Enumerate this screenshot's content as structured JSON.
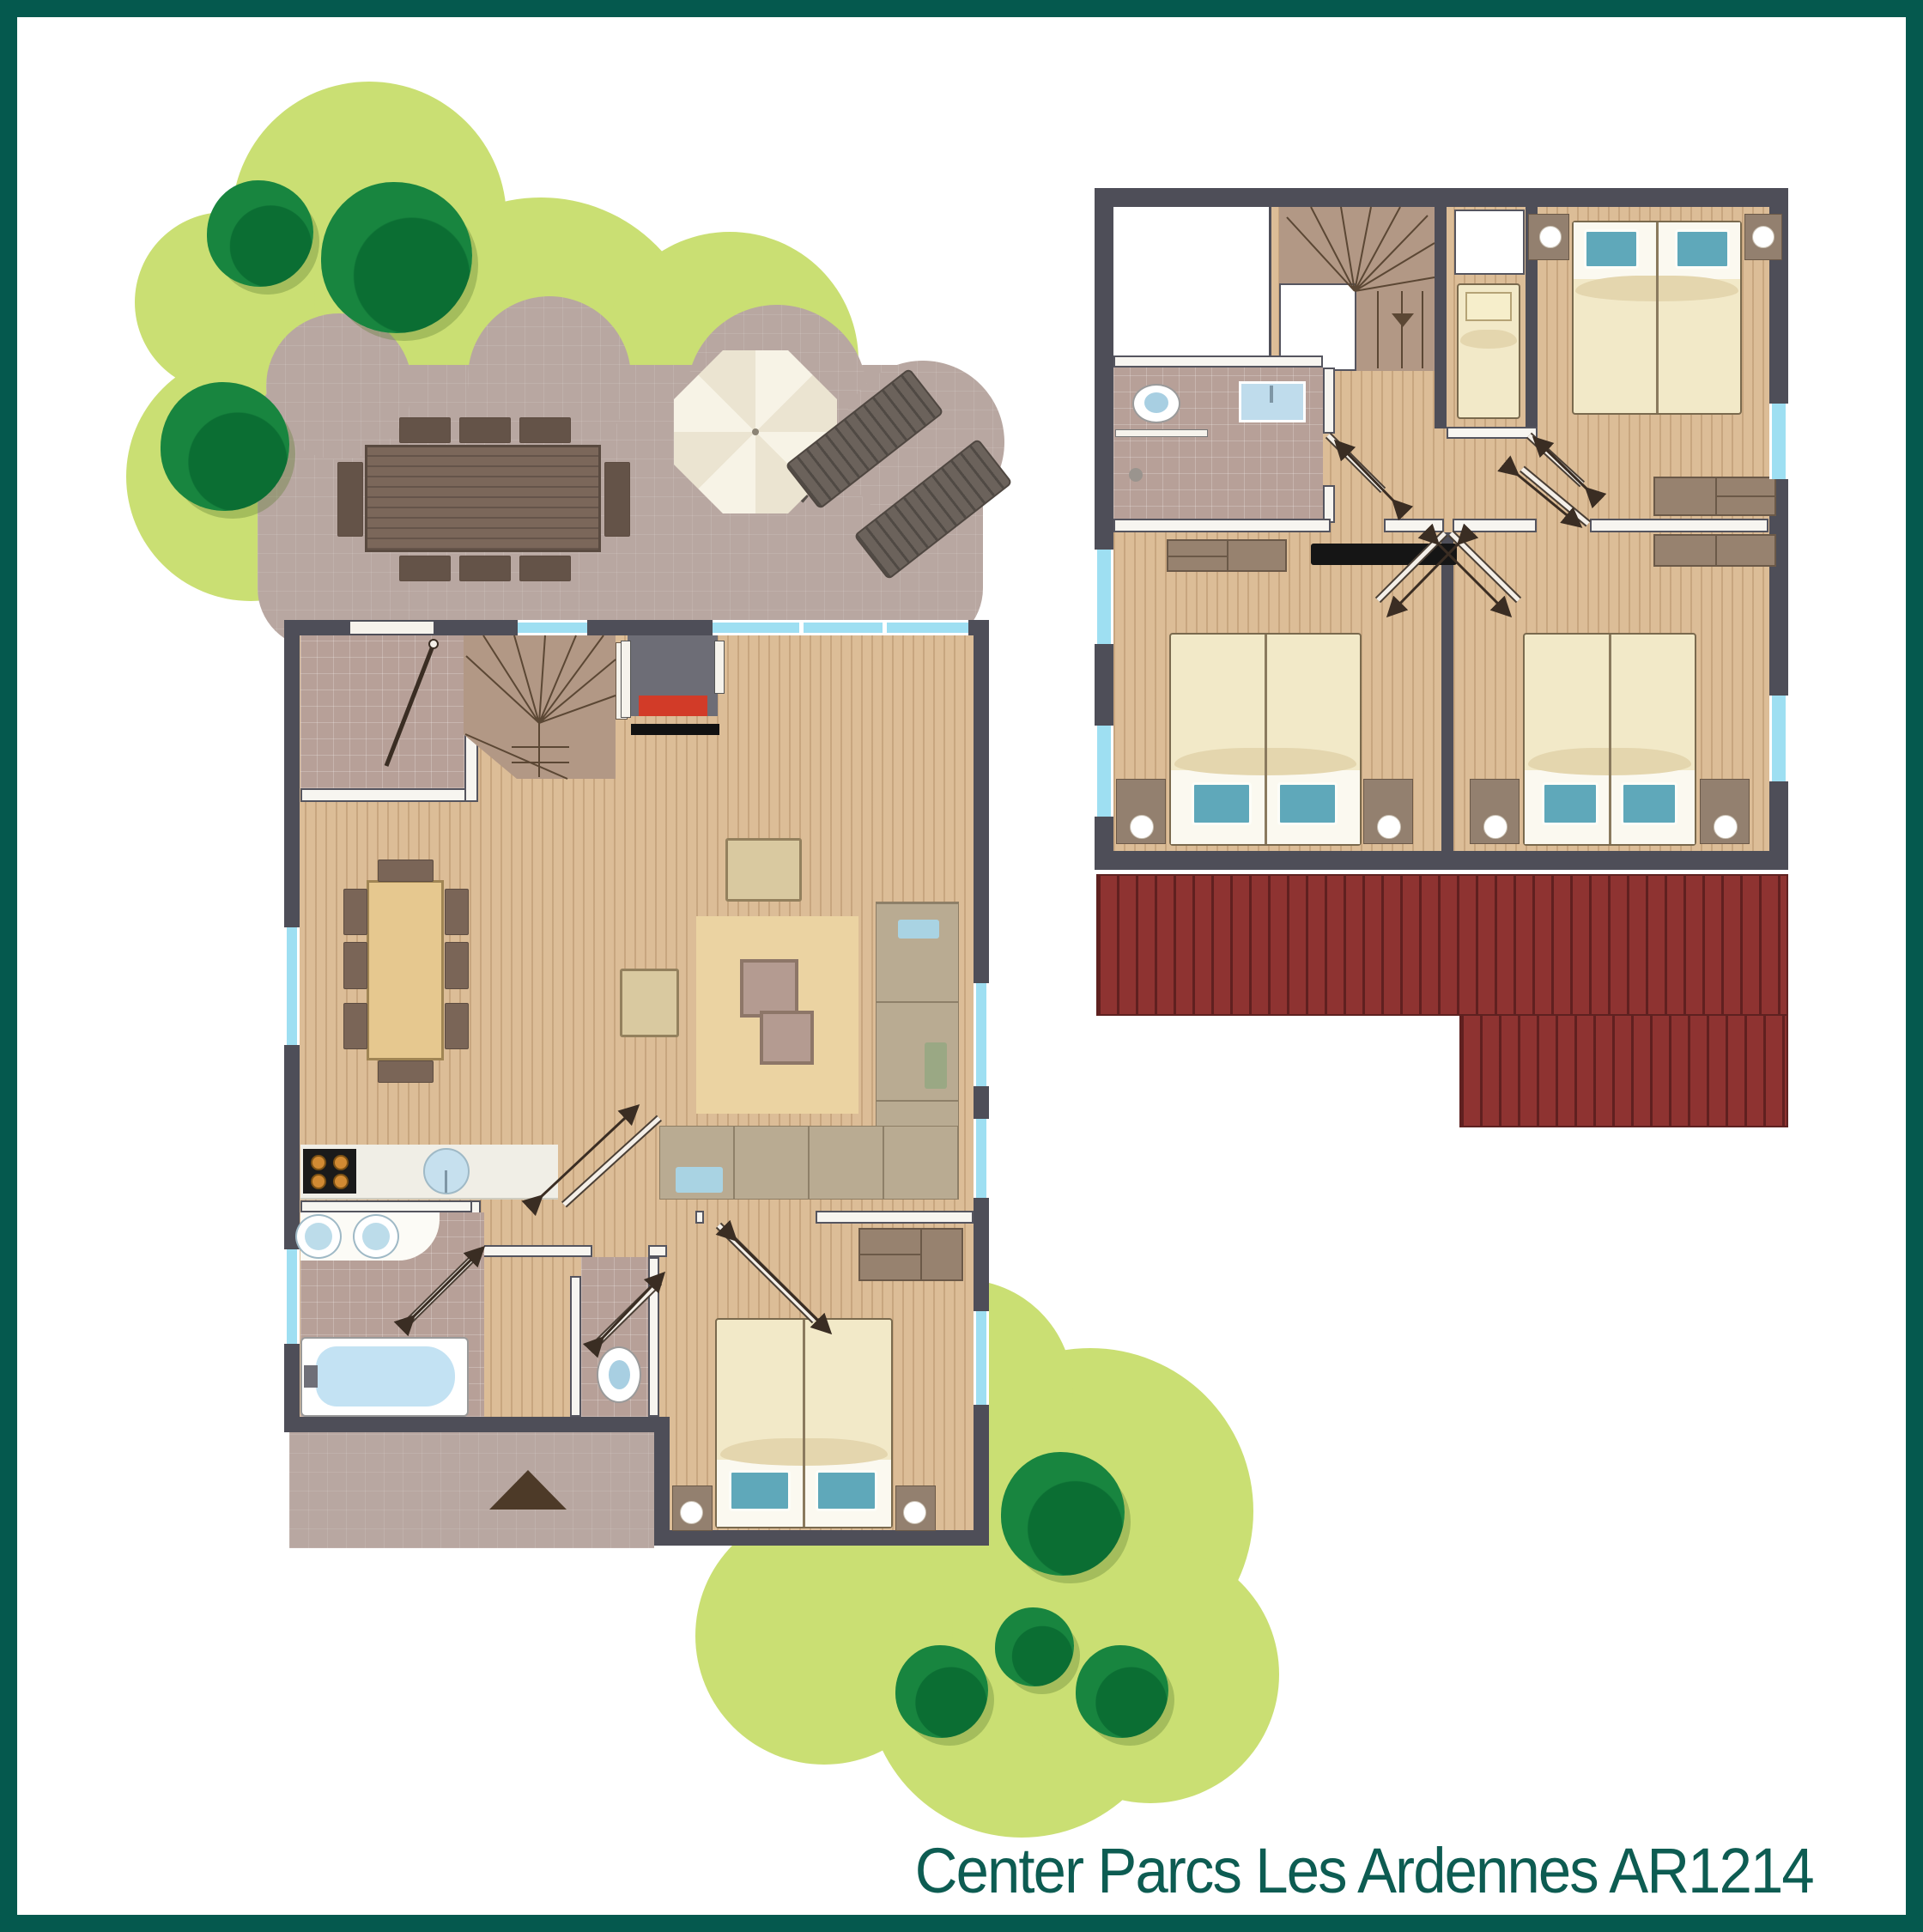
{
  "type": "floor-plan-diagram",
  "title": "Center Parcs Les Ardennes AR1214",
  "resort": "Center Parcs Les Ardennes",
  "cottage_code": "AR1214",
  "plans": [
    {
      "id": "ground-floor",
      "rooms": [
        "garden",
        "terrace",
        "entrance-hall",
        "staircase",
        "lounge-with-fireplace",
        "dining-area",
        "open-kitchen",
        "bathroom",
        "separate-toilet",
        "double-bedroom"
      ],
      "furniture": [
        "outdoor-dining-table-with-chairs",
        "parasol",
        "two-sun-loungers",
        "dining-table-8-chairs",
        "hob",
        "kitchen-sink",
        "double-washbasin",
        "bathtub",
        "toilet",
        "double-bed",
        "two-bedside-tables",
        "wardrobe",
        "l-shaped-sofa",
        "two-armchairs",
        "two-coffee-tables",
        "rug",
        "fireplace"
      ]
    },
    {
      "id": "first-floor",
      "rooms": [
        "landing",
        "staircase",
        "bathroom",
        "single-bedroom",
        "double-bedroom-1",
        "double-bedroom-2",
        "double-bedroom-3",
        "lower-roof"
      ],
      "furniture": [
        "toilet",
        "washbasin",
        "single-bed",
        "three-double-beds",
        "bedside-tables-with-lamps",
        "wardrobes",
        "dresser",
        "tv"
      ]
    }
  ],
  "colors": {
    "frame": "#05594e",
    "title_text": "#0d5c52",
    "garden": "#cadf73",
    "tree": "#18853f",
    "terrace": "#b8a7a1",
    "wall": "#4e4e58",
    "wood_floor": "#dcbd97",
    "window": "#9edff2",
    "roof": "#8e3331",
    "bed": "#f2e9c8",
    "pillow": "#5fa8ba",
    "bathtub": "#c3e2f3",
    "tile": "#b7a098",
    "sofa": "#b9ab92",
    "rug": "#ebd3a2",
    "dining_table": "#e6c88f",
    "fireplace_fire": "#d23b28"
  }
}
